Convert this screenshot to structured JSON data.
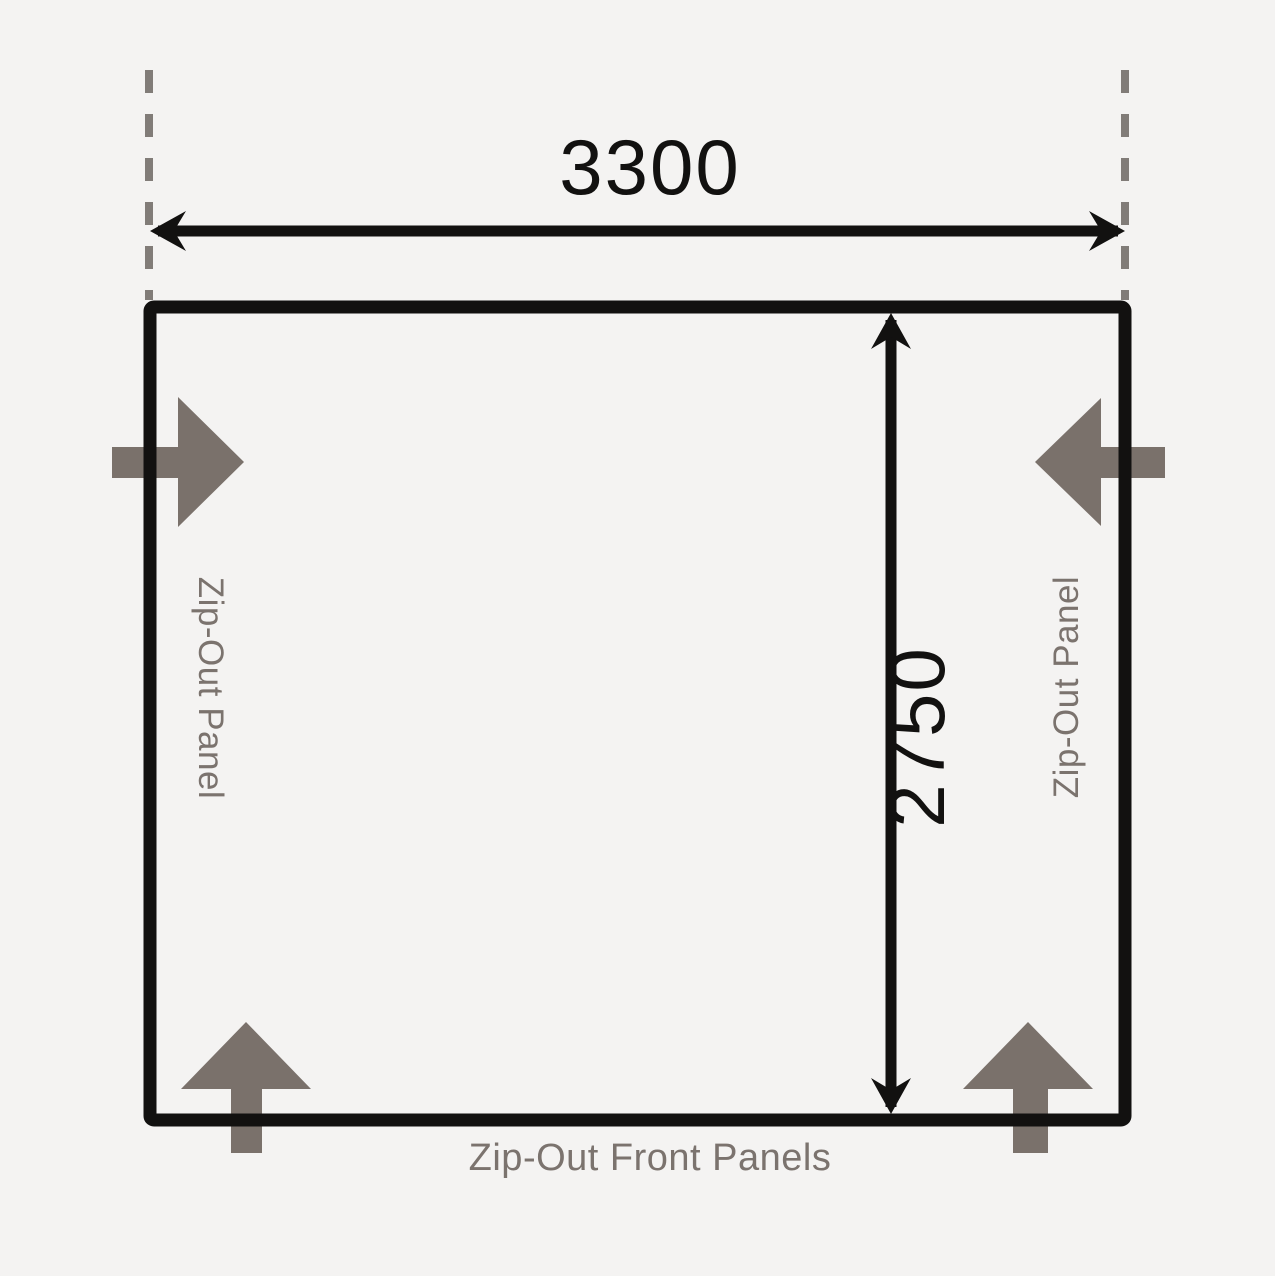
{
  "diagram": {
    "width_mm": "3300",
    "depth_mm": "2750",
    "left_panel_label": "Zip-Out Panel",
    "right_panel_label": "Zip-Out Panel",
    "front_panels_label": "Zip-Out Front Panels"
  },
  "colors": {
    "background": "#f4f3f2",
    "outline": "#121110",
    "arrow_gray": "#7a716b",
    "label_gray": "#7b736e",
    "dashed_gray": "#817c78"
  }
}
